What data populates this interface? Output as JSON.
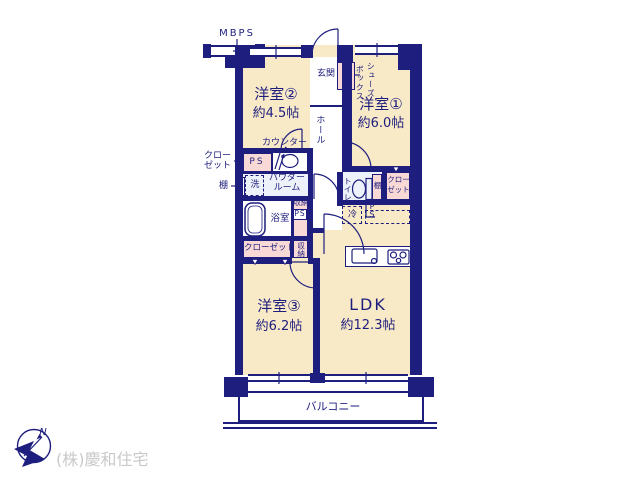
{
  "plan": {
    "type": "floorplan",
    "colors": {
      "wall": "#1e1e7e",
      "floor": "#f8e9c7",
      "storage_pink": "#f8d9d6",
      "tile_blue": "#edf2fa",
      "company_text": "#c9c9c9"
    },
    "rooms": {
      "room1": {
        "name": "洋室①",
        "size": "約6.0帖"
      },
      "room2": {
        "name": "洋室②",
        "size": "約4.5帖"
      },
      "room3": {
        "name": "洋室③",
        "size": "約6.2帖"
      },
      "ldk": {
        "name": "LDK",
        "size": "約12.3帖"
      }
    },
    "labels": {
      "mbps": "MBPS",
      "genkan": "玄関",
      "hall": "ホール",
      "shoes_col_right": "シューズ",
      "shoes_col_left": "ボックス",
      "counter": "カウンター",
      "closet_left_line1": "クロー",
      "closet_left_line2": "ゼット",
      "shelf_left": "棚",
      "ps_top": "PS",
      "washer": "洗",
      "powder_line1": "パウダー",
      "powder_line2": "ルーム",
      "bath": "浴室",
      "storage_mid": "収納",
      "ps_mid": "PS",
      "closet_bottom": "クローゼット",
      "storage_bottom": "収納",
      "toilet": "トイレ",
      "shelf_toilet": "棚",
      "closet_right_line1": "クロー",
      "closet_right_line2": "ゼット",
      "fridge": "冷",
      "ps_right": "PS",
      "balcony": "バルコニー"
    },
    "footer": {
      "compass_north": "N",
      "company": "(株)慶和住宅"
    }
  }
}
